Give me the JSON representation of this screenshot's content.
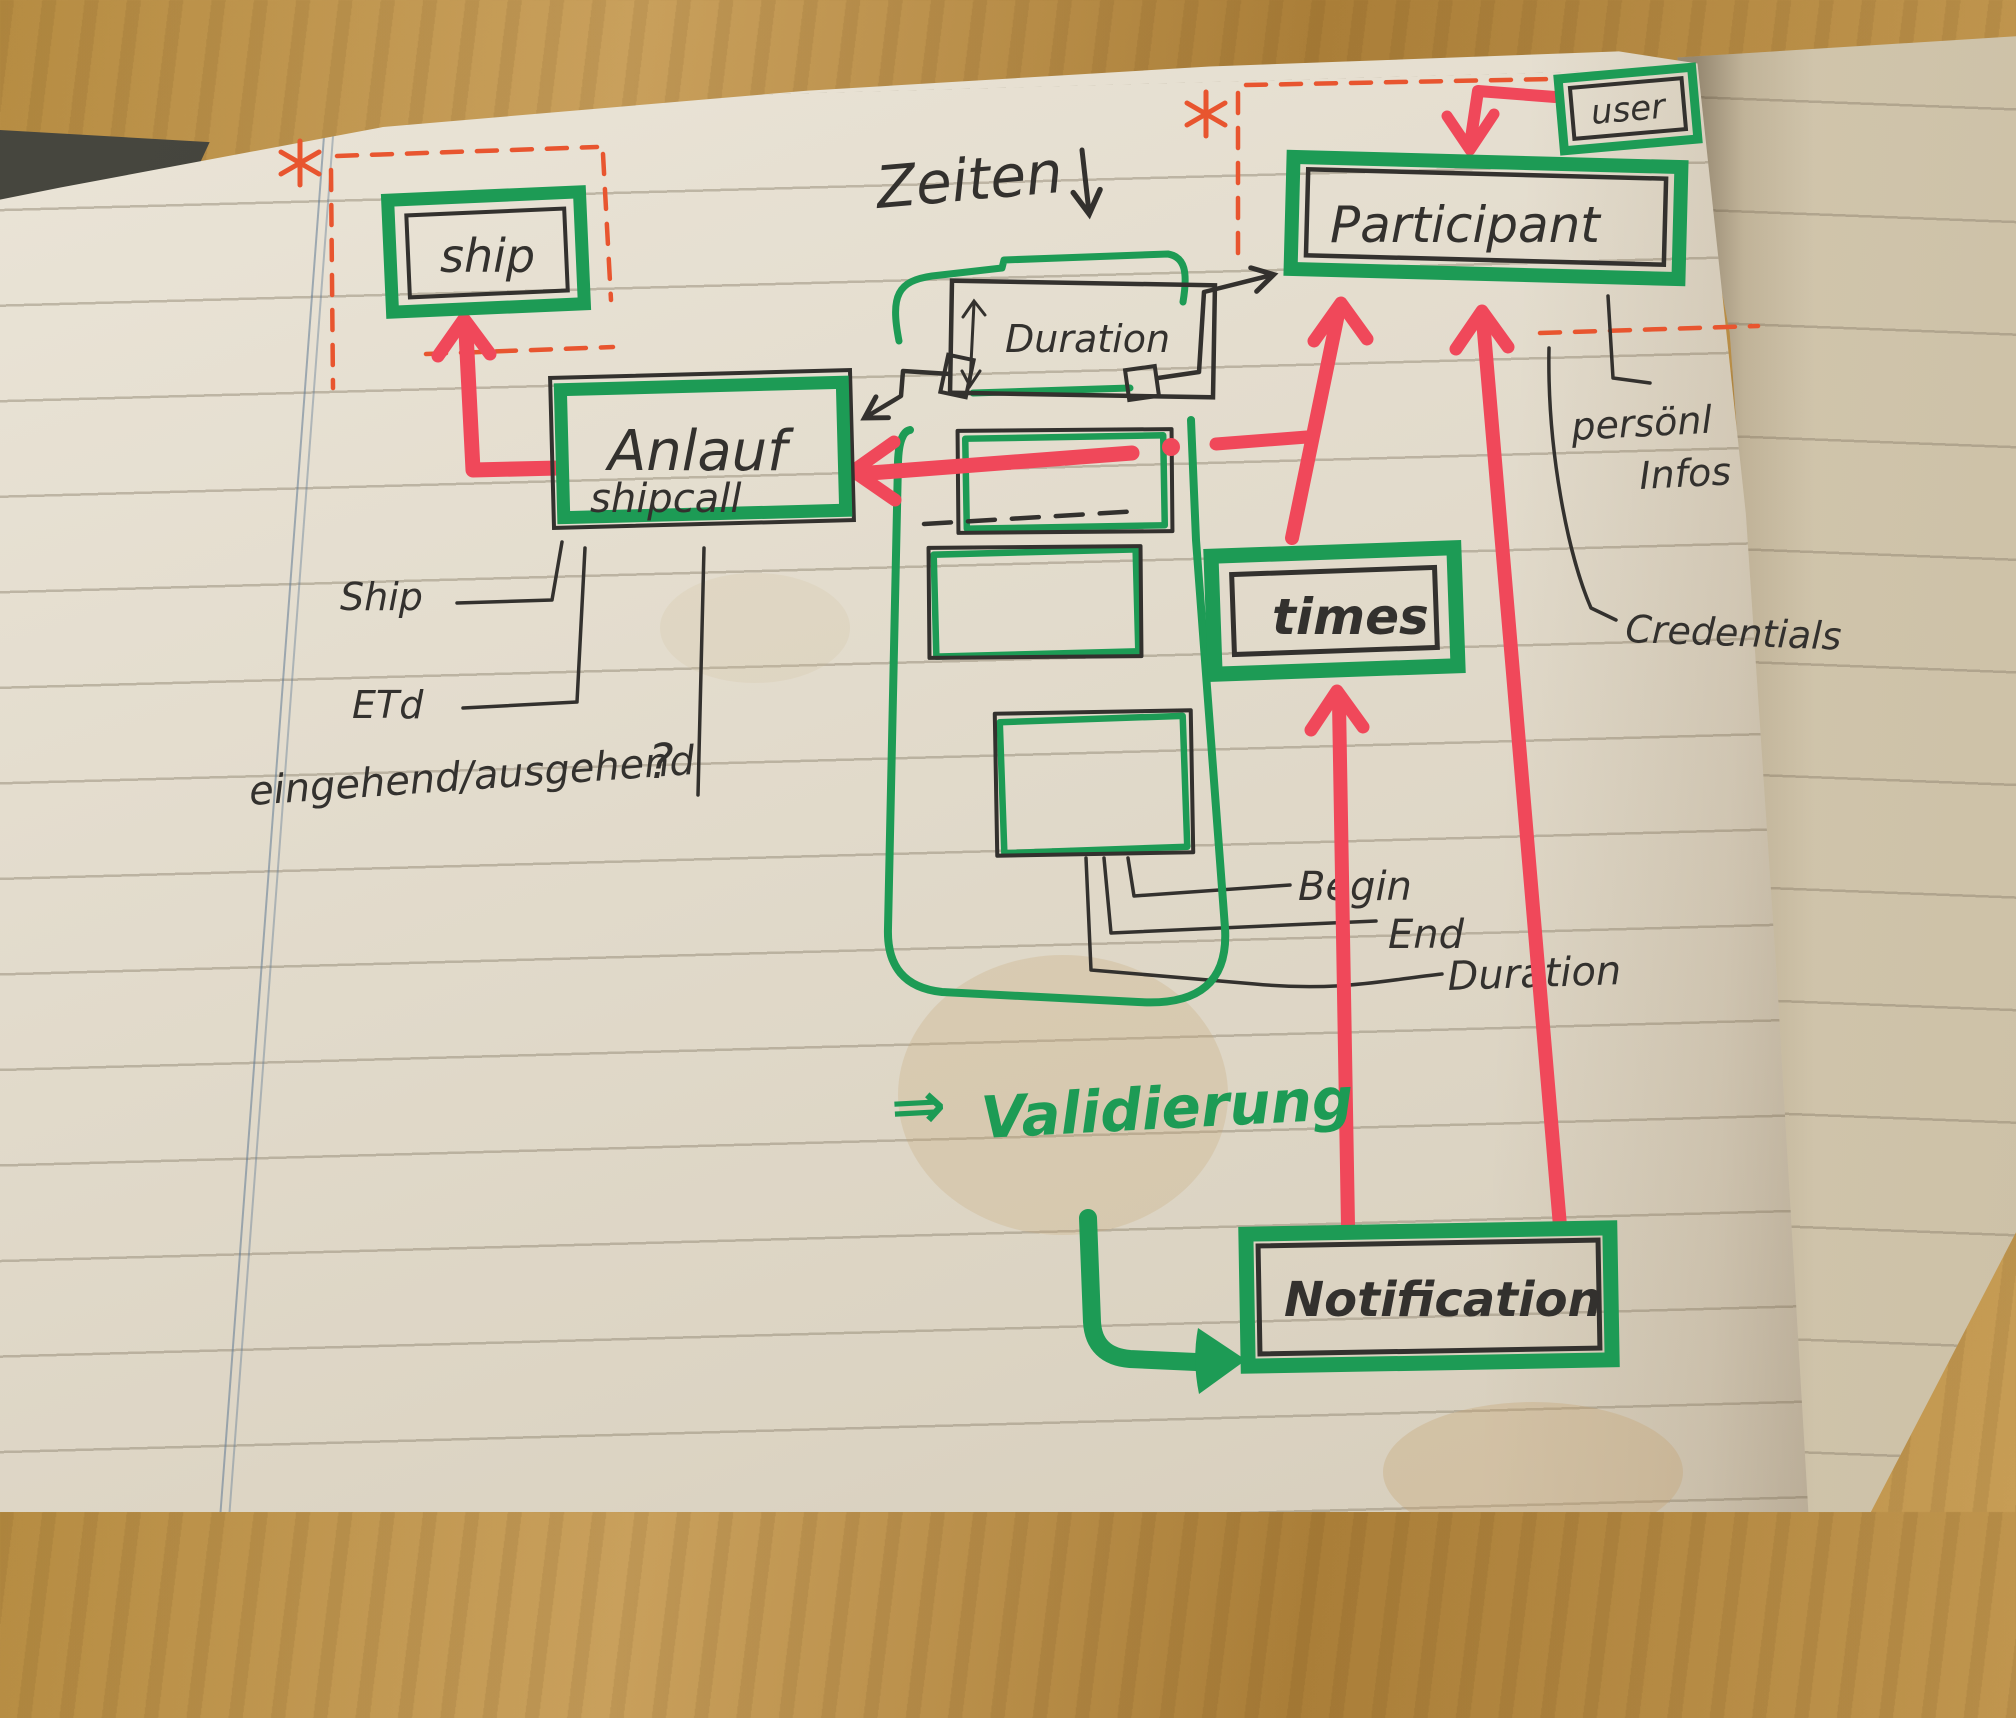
{
  "diagram": {
    "nodes": {
      "ship": {
        "label": "ship"
      },
      "anlauf": {
        "label": "Anlauf",
        "sublabel": "shipcall"
      },
      "duration_box": {
        "label": "Duration"
      },
      "participant": {
        "label": "Participant"
      },
      "user": {
        "label": "user"
      },
      "times": {
        "label": "times"
      },
      "notification": {
        "label": "Notification"
      }
    },
    "labels": {
      "zeiten": "Zeiten",
      "ship_ref": "Ship",
      "etd": "ETd",
      "in_out": "eingehend/ausgehend",
      "question_mark": "?",
      "personal_info_line1": "persönl",
      "personal_info_line2": "Infos",
      "credentials": "Credentials",
      "begin": "Begin",
      "end": "End",
      "duration_ref": "Duration",
      "validation_arrow": "⇒",
      "validation": "Validierung"
    },
    "colors": {
      "marker_green": "#1d9b55",
      "marker_red": "#f0485a",
      "dashed_red": "#e8552f",
      "pen_black": "#33312e",
      "paper": "#e3dccd"
    }
  }
}
